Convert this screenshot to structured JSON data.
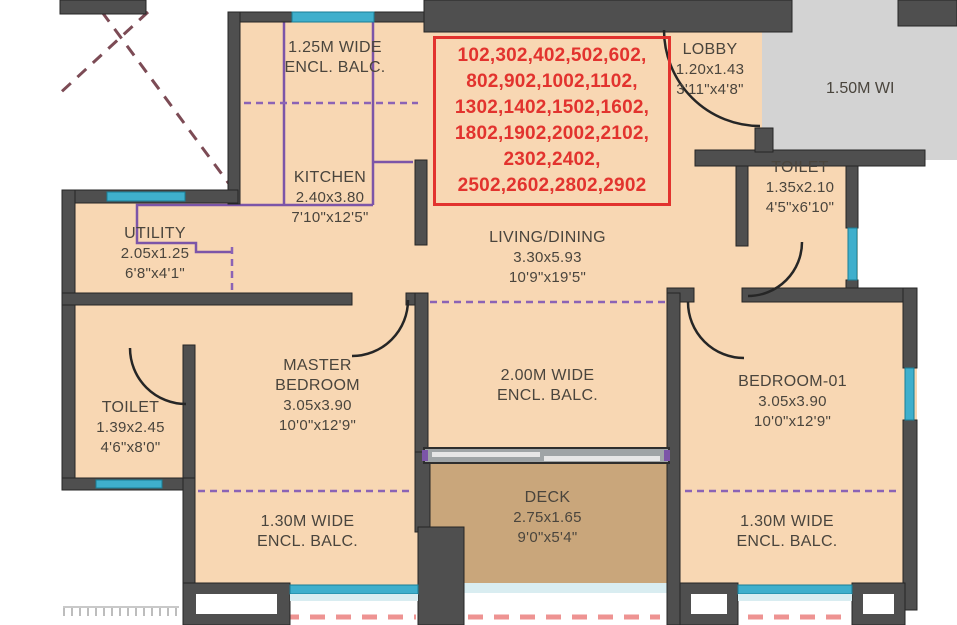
{
  "units": {
    "lines": [
      "102,302,402,502,602,",
      "802,902,1002,1102,",
      "1302,1402,1502,1602,",
      "1802,1902,2002,2102,",
      "2302,2402,",
      "2502,2602,2802,2902"
    ]
  },
  "rooms": {
    "balcony_top": {
      "line1": "1.25M WIDE",
      "line2": "ENCL. BALC."
    },
    "kitchen": {
      "name": "KITCHEN",
      "dim_m": "2.40x3.80",
      "dim_ft": "7'10\"x12'5\""
    },
    "utility": {
      "name": "UTILITY",
      "dim_m": "2.05x1.25",
      "dim_ft": "6'8\"x4'1\""
    },
    "lobby": {
      "name": "LOBBY",
      "dim_m": "1.20x1.43",
      "dim_ft": "3'11\"x4'8\""
    },
    "corridor": {
      "label": "1.50M WI"
    },
    "toilet_top": {
      "name": "TOILET",
      "dim_m": "1.35x2.10",
      "dim_ft": "4'5\"x6'10\""
    },
    "living": {
      "name": "LIVING/DINING",
      "dim_m": "3.30x5.93",
      "dim_ft": "10'9\"x19'5\""
    },
    "master_bedroom": {
      "name1": "MASTER",
      "name2": "BEDROOM",
      "dim_m": "3.05x3.90",
      "dim_ft": "10'0\"x12'9\""
    },
    "balcony_mid": {
      "line1": "2.00M WIDE",
      "line2": "ENCL. BALC."
    },
    "bedroom_01": {
      "name": "BEDROOM-01",
      "dim_m": "3.05x3.90",
      "dim_ft": "10'0\"x12'9\""
    },
    "toilet_left": {
      "name": "TOILET",
      "dim_m": "1.39x2.45",
      "dim_ft": "4'6\"x8'0\""
    },
    "balcony_bl": {
      "line1": "1.30M WIDE",
      "line2": "ENCL. BALC."
    },
    "deck": {
      "name": "DECK",
      "dim_m": "2.75x1.65",
      "dim_ft": "9'0\"x5'4\""
    },
    "balcony_br": {
      "line1": "1.30M WIDE",
      "line2": "ENCL. BALC."
    }
  },
  "colors": {
    "room_fill": "#f8d7b3",
    "deck_fill": "#c9a67b",
    "wall": "#4f4f4f",
    "window": "#3fafcc",
    "corridor_gray": "#d3d3d3",
    "accent_red": "#e2332e",
    "purple": "#7c55a8",
    "pink_dash": "#ee9392",
    "maroon_dash": "#7c4b55"
  }
}
